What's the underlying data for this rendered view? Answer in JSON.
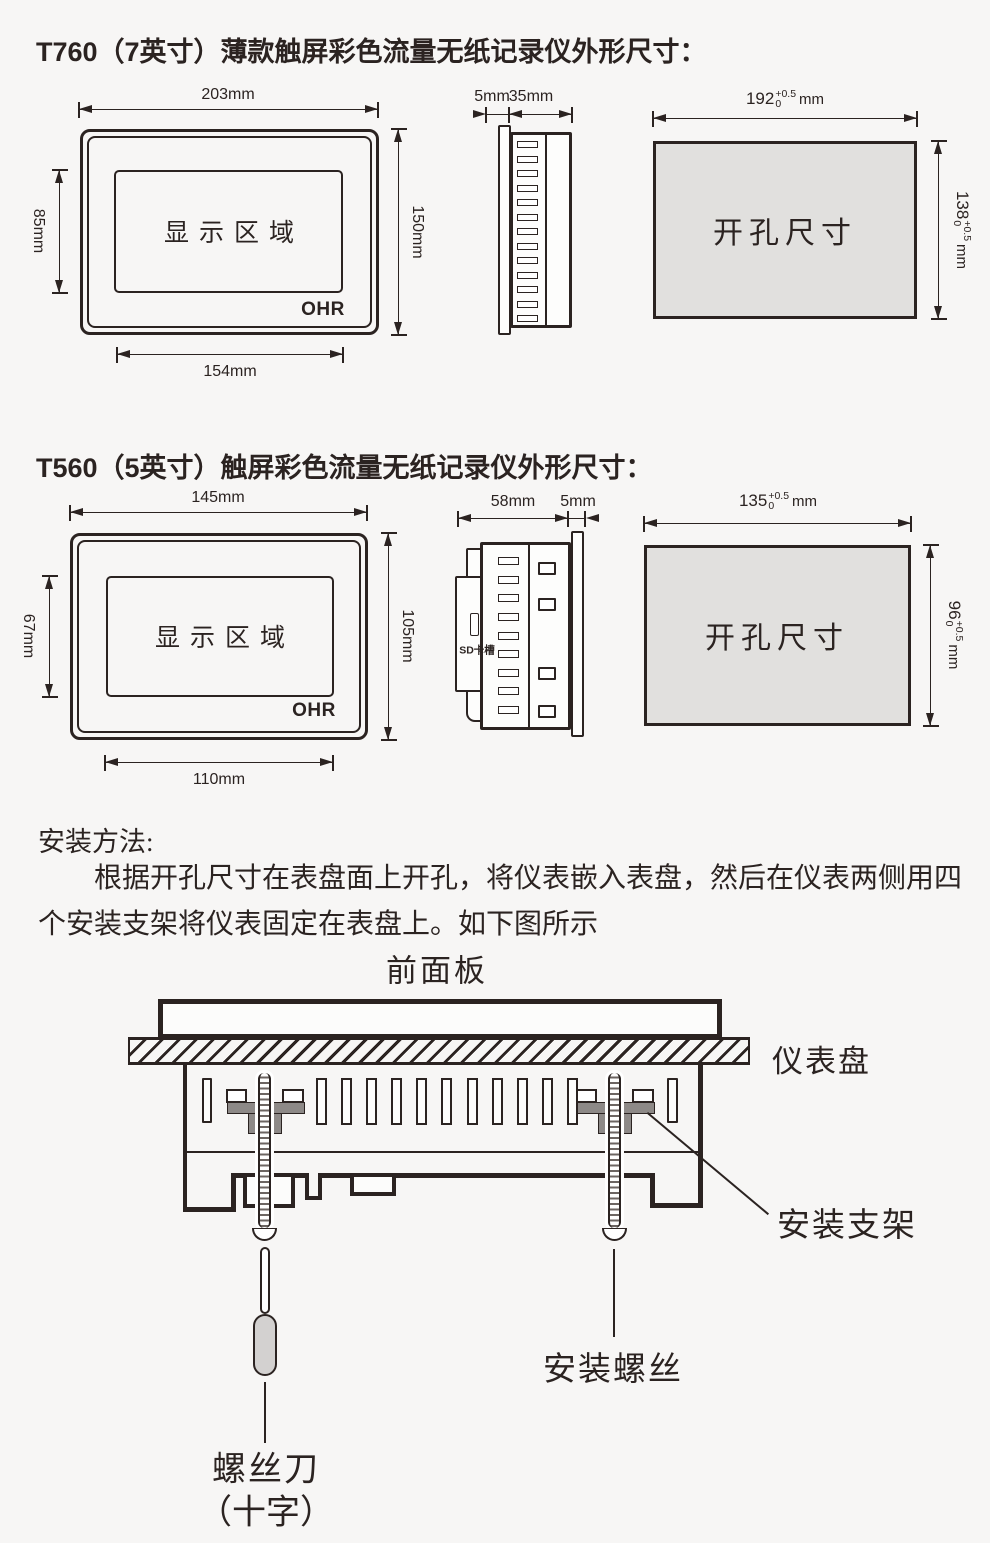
{
  "colors": {
    "ink": "#2b2321",
    "bg": "#f7f6f5",
    "cut": "#e1e0de",
    "brk": "#8d8987",
    "handle": "#d3d1d0"
  },
  "t760": {
    "title": "T760（7英寸）薄款触屏彩色流量无纸记录仪外形尺寸：",
    "front": {
      "dim_top": "203mm",
      "dim_left": "85mm",
      "dim_right": "150mm",
      "dim_bottom": "154mm",
      "display": "显示区域",
      "logo": "OHR"
    },
    "side": {
      "dim_bezel": "5mm",
      "dim_depth": "35mm"
    },
    "cutout": {
      "label": "开孔尺寸",
      "w": "192",
      "w_sup": "+0.5",
      "w_sub": "0",
      "w_unit": "mm",
      "h": "138",
      "h_sup": "+0.5",
      "h_sub": "0",
      "h_unit": "mm"
    }
  },
  "t560": {
    "title": "T560（5英寸）触屏彩色流量无纸记录仪外形尺寸：",
    "front": {
      "dim_top": "145mm",
      "dim_left": "67mm",
      "dim_right": "105mm",
      "dim_bottom": "110mm",
      "display": "显示区域",
      "logo": "OHR"
    },
    "side": {
      "dim_depth": "58mm",
      "dim_bezel": "5mm",
      "sd_label": "SD卡槽"
    },
    "cutout": {
      "label": "开孔尺寸",
      "w": "135",
      "w_sup": "+0.5",
      "w_sub": "0",
      "w_unit": "mm",
      "h": "96",
      "h_sup": "+0.5",
      "h_sub": "0",
      "h_unit": "mm"
    }
  },
  "install": {
    "heading": "安装方法:",
    "line1": "根据开孔尺寸在表盘面上开孔，将仪表嵌入表盘，然后在仪表两侧用四",
    "line2": "个安装支架将仪表固定在表盘上。如下图所示",
    "front_panel": "前面板",
    "panel": "仪表盘",
    "bracket": "安装支架",
    "screw": "安装螺丝",
    "driver1": "螺丝刀",
    "driver2": "（十字）"
  }
}
